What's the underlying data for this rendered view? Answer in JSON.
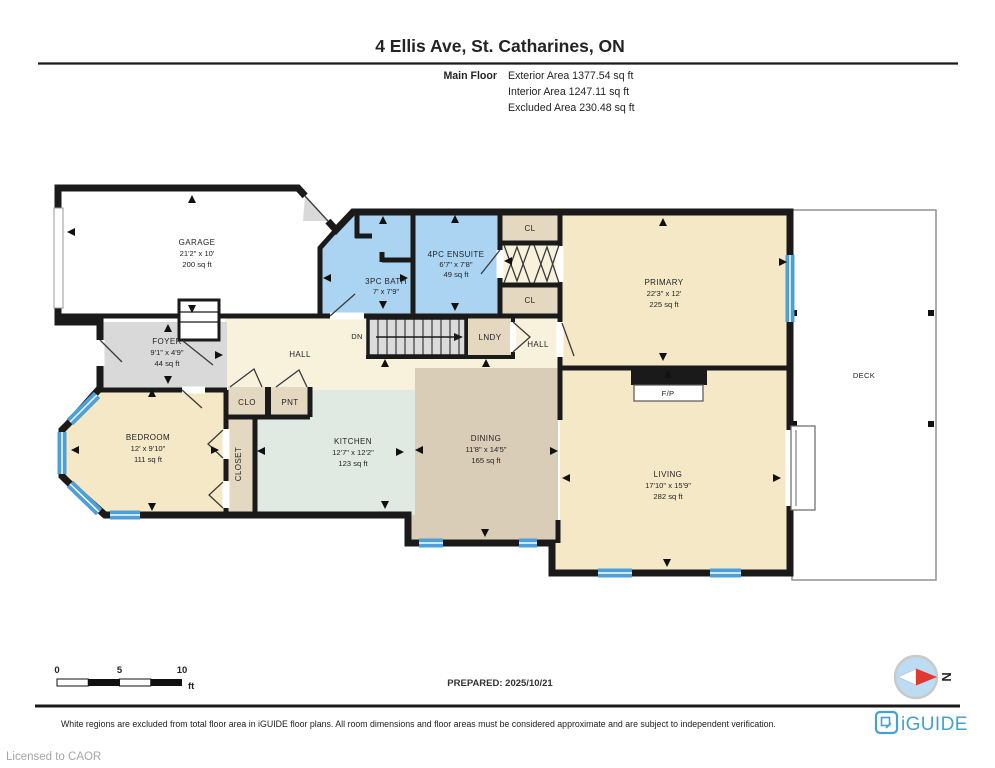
{
  "header": {
    "title": "4 Ellis Ave, St. Catharines, ON",
    "floor_label": "Main Floor",
    "exterior_area": "Exterior Area 1377.54 sq ft",
    "interior_area": "Interior Area 1247.11 sq ft",
    "excluded_area": "Excluded Area 230.48 sq ft"
  },
  "rooms": {
    "garage": {
      "name": "GARAGE",
      "dims": "21'2\" x 10'",
      "area": "200 sq ft"
    },
    "bath_3pc": {
      "name": "3PC BATH",
      "dims": "7' x 7'9\""
    },
    "ensuite_4pc": {
      "name": "4PC ENSUITE",
      "dims": "6'7\" x 7'8\"",
      "area": "49 sq ft"
    },
    "closet_top": {
      "name": "CL"
    },
    "closet_bottom": {
      "name": "CL"
    },
    "primary": {
      "name": "PRIMARY",
      "dims": "22'3\" x 12'",
      "area": "225 sq ft"
    },
    "foyer": {
      "name": "FOYER",
      "dims": "9'1\" x 4'9\"",
      "area": "44 sq ft"
    },
    "hall": {
      "name": "HALL"
    },
    "hall_back": {
      "name": "HALL"
    },
    "laundry": {
      "name": "LNDY"
    },
    "stairs": {
      "label": "DN"
    },
    "clo": {
      "name": "CLO"
    },
    "pantry": {
      "name": "PNT"
    },
    "bedroom": {
      "name": "BEDROOM",
      "dims": "12' x 9'10\"",
      "area": "111 sq ft"
    },
    "closet": {
      "name": "CLOSET"
    },
    "kitchen": {
      "name": "KITCHEN",
      "dims": "12'7\" x 12'2\"",
      "area": "123 sq ft"
    },
    "dining": {
      "name": "DINING",
      "dims": "11'8\" x 14'5\"",
      "area": "165 sq ft"
    },
    "living": {
      "name": "LIVING",
      "dims": "17'10\" x 15'9\"",
      "area": "282 sq ft"
    },
    "fireplace": {
      "name": "F/P"
    },
    "deck": {
      "name": "DECK"
    }
  },
  "scale_bar": {
    "start": "0",
    "mid": "5",
    "end": "10",
    "unit": "ft"
  },
  "prepared": "PREPARED: 2025/10/21",
  "compass": {
    "north_label": "N"
  },
  "footer": {
    "disclaimer": "White regions are excluded from total floor area in iGUIDE floor plans. All room dimensions and floor areas must be considered approximate and are subject to independent verification.",
    "brand": "iGUIDE",
    "license": "Licensed to CAOR"
  },
  "palette": {
    "wall": "#1a1a1a",
    "cream": "#f5e8c6",
    "cream_light": "#f8f1dc",
    "blue_room": "#abd4f2",
    "beige": "#e5d8c0",
    "gray": "#d9d9d9",
    "mint": "#e0eae2",
    "tan": "#d9cdb8",
    "window": "#4c9fd7",
    "stair": "#dbdbdb",
    "brand": "#44a0d6",
    "compass_fill": "#bbdcf2",
    "compass_red": "#e03a2f",
    "muted": "#a6a6a6"
  }
}
